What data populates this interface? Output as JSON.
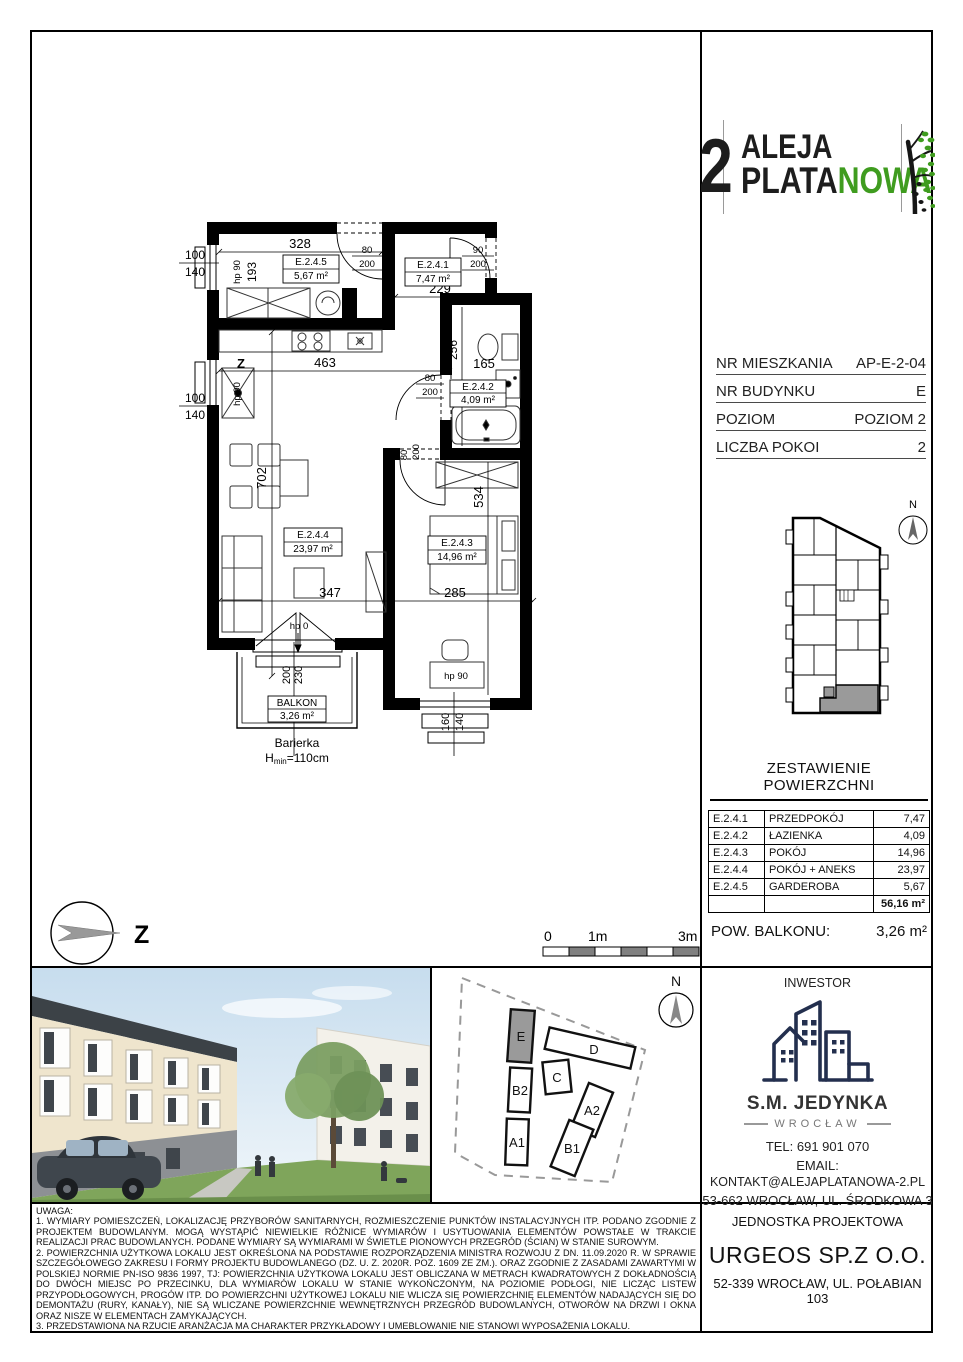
{
  "logo": {
    "number": "2",
    "line1": "ALEJA",
    "line2_black": "PLATA",
    "line2_green": "NOWA",
    "green_color": "#3f9c1f"
  },
  "info_table": {
    "rows": [
      {
        "label": "NR MIESZKANIA",
        "value": "AP-E-2-04"
      },
      {
        "label": "NR BUDYNKU",
        "value": "E"
      },
      {
        "label": "POZIOM",
        "value": "POZIOM 2"
      },
      {
        "label": "LICZBA POKOI",
        "value": "2"
      }
    ]
  },
  "area_table": {
    "title": "ZESTAWIENIE POWIERZCHNI",
    "rows": [
      {
        "code": "E.2.4.1",
        "name": "PRZEDPOKÓJ",
        "area": "7,47"
      },
      {
        "code": "E.2.4.2",
        "name": "ŁAZIENKA",
        "area": "4,09"
      },
      {
        "code": "E.2.4.3",
        "name": "POKÓJ",
        "area": "14,96"
      },
      {
        "code": "E.2.4.4",
        "name": "POKÓJ + ANEKS",
        "area": "23,97"
      },
      {
        "code": "E.2.4.5",
        "name": "GARDEROBA",
        "area": "5,67"
      }
    ],
    "total": "56,16 m²"
  },
  "balcony_row": {
    "label": "POW. BALKONU:",
    "value": "3,26 m²"
  },
  "investor": {
    "title": "INWESTOR",
    "name": "S.M. JEDYNKA",
    "city": "WROCŁAW",
    "tel": "TEL: 691 901 070",
    "email_label": "EMAIL:",
    "email": "KONTAKT@ALEJAPLATANOWA-2.PL",
    "address": "53-662 WROCŁAW, UL. ŚRODKOWA 3"
  },
  "design_unit": {
    "title": "JEDNOSTKA PROJEKTOWA",
    "name": "URGEOS SP.Z O.O.",
    "address": "52-339 WROCŁAW, UL. POŁABIAN 103"
  },
  "notes": {
    "title": "UWAGA:",
    "item1": "1. WYMIARY POMIESZCZEŃ, LOKALIZACJĘ PRZYBORÓW SANITARNYCH, ROZMIESZCZENIE PUNKTÓW INSTALACYJNYCH ITP. PODANO ZGODNIE Z PROJEKTEM BUDOWLANYM. MOGĄ WYSTĄPIĆ NIEWIELKIE RÓŻNICE WYMIARÓW I USYTUOWANIA ELEMENTÓW POWSTAŁE W TRAKCIE REALIZACJI PRAC BUDOWLANYCH. PODANE WYMIARY SĄ WYMIARAMI W ŚWIETLE PIONOWYCH PRZEGRÓD (ŚCIAN) W STANIE SUROWYM.",
    "item2": "2. POWIERZCHNIA UŻYTKOWA LOKALU JEST OKREŚLONA NA PODSTAWIE ROZPORZĄDZENIA MINISTRA ROZWOJU Z DN. 11.09.2020 R. W SPRAWIE SZCZEGÓŁOWEGO ZAKRESU I FORMY PROJEKTU BUDOWLANEGO (DZ. U. Z. 2020R. POZ. 1609 ZE ZM.). ORAZ ZGODNIE Z ZASADAMI ZAWARTYMI W POLSKIEJ NORMIE PN-ISO 9836 1997, TJ: POWIERZCHNIA UŻYTKOWA LOKALU JEST OBLICZANA W METRACH KWADRATOWYCH Z DOKŁADNOŚCIĄ DO DWÓCH MIEJSC PO PRZECINKU, DLA WYMIARÓW LOKALU W STANIE WYKOŃCZONYM, NA POZIOMIE PODŁOGI, NIE LICZĄC LISTEW PRZYPODŁOGOWYCH, PROGÓW ITP. DO POWIERZCHNI UŻYTKOWEJ LOKALU NIE WLICZA SIĘ POWIERZCHNIĘ ELEMENTÓW NADAJĄCYCH SIĘ DO DEMONTAŻU (RURY, KANAŁY), NIE SĄ WLICZANE POWIERZCHNIE WEWNĘTRZNYCH PRZEGRÓD BUDOWLANYCH, OTWORÓW NA DRZWI I OKNA ORAZ NISZE W ELEMENTACH ZAMYKAJĄCYCH.",
    "item3": "3. PRZEDSTAWIONA NA RZUCIE ARANŻACJA MA CHARAKTER PRZYKŁADOWY I UMEBLOWANIE NIE STANOWI WYPOSAŻENIA LOKALU."
  },
  "floor_plan": {
    "rooms": {
      "garderoba": {
        "code": "E.2.4.5",
        "area": "5,67 m²"
      },
      "przedpokoj": {
        "code": "E.2.4.1",
        "area": "7,47 m²"
      },
      "lazienka": {
        "code": "E.2.4.2",
        "area": "4,09 m²"
      },
      "pokoj": {
        "code": "E.2.4.3",
        "area": "14,96 m²"
      },
      "pokoj_aneks": {
        "code": "E.2.4.4",
        "area": "23,97 m²"
      }
    },
    "balkon": {
      "name": "BALKON",
      "area": "3,26 m²"
    },
    "barrier": {
      "line1": "Barierka",
      "h": "H",
      "sub": "min",
      "rest": "=110cm"
    },
    "dims": {
      "top_width": "328",
      "hall_width": "229",
      "gard_depth": "193",
      "hall_depth": "193",
      "door_gard_w": "80",
      "door_gard_h": "200",
      "door_entry_w": "90",
      "door_entry_h": "200",
      "door_bath_w": "80",
      "door_bath_h": "200",
      "door_bed_w": "80",
      "door_bed_h": "200",
      "win1_w": "100",
      "win1_h": "140",
      "win2_w": "100",
      "win2_h": "140",
      "corridor_width": "463",
      "bath_depth": "256",
      "bath_width": "165",
      "living_depth": "702",
      "bed_depth": "534",
      "living_width": "347",
      "bed_width": "285",
      "balc_door_w": "200",
      "balc_door_h": "230",
      "bed_win_w": "160",
      "bed_win_h": "140",
      "hp90_win1": "hp 90",
      "hp90_win2": "hp 90",
      "hp0": "hp 0",
      "hp90_bed": "hp 90",
      "north_letter": "Z"
    }
  },
  "compass_main": {
    "letter": "Z"
  },
  "scale_bar": {
    "zero": "0",
    "one": "1m",
    "three": "3m"
  },
  "mini_map": {
    "north": "N"
  },
  "site_plan": {
    "north": "N",
    "buildings": [
      {
        "label": "E"
      },
      {
        "label": "B2"
      },
      {
        "label": "A1"
      },
      {
        "label": "C"
      },
      {
        "label": "D"
      },
      {
        "label": "A2"
      },
      {
        "label": "B1"
      }
    ],
    "highlighted": "E",
    "highlight_color": "#9a9a9a"
  }
}
